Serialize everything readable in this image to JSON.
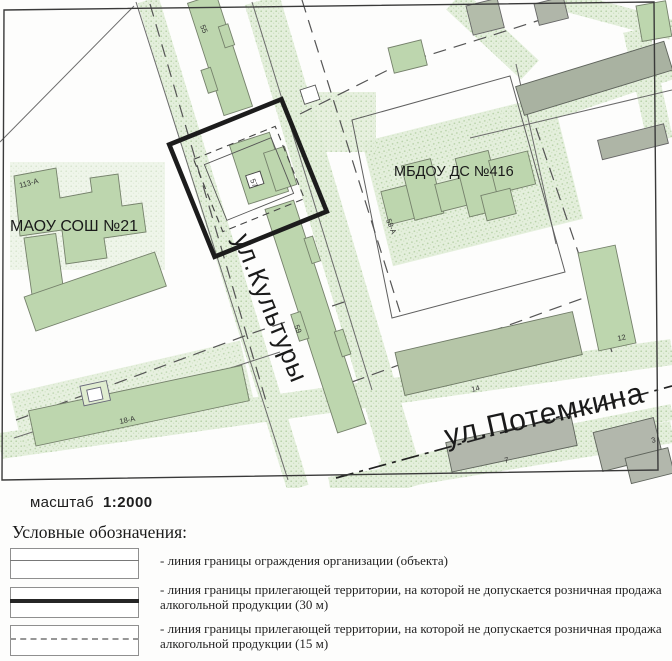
{
  "map": {
    "scale_label": "масштаб",
    "scale_value": "1:2000",
    "streets": {
      "kultury": "ул.Культуры",
      "potemkina": "ул.Потемкина"
    },
    "facilities": {
      "school": "МАОУ СОШ №21",
      "kindergarten": "МБДОУ ДС №416"
    },
    "numbers": {
      "b113": "113-А",
      "b55": "55",
      "b57": "57",
      "b59": "59",
      "b59a": "59-А",
      "b18a": "18-А",
      "b14": "14",
      "b12": "12",
      "b7": "7",
      "b3": "3"
    },
    "colors": {
      "building_green": "#bdd6ae",
      "building_gray": "#aeb5a6",
      "vegetation": "#e2eeda",
      "boundary_30m": "#1c1c1c"
    }
  },
  "legend": {
    "title": "Условные обозначения:",
    "items": [
      {
        "type": "thin-solid",
        "label": "- линия границы ограждения организации (объекта)"
      },
      {
        "type": "thick-solid",
        "label": "- линия границы прилегающей территории, на которой не допускается розничная продажа алкогольной продукции (30 м)"
      },
      {
        "type": "dashed",
        "label": "- линия границы прилегающей территории, на которой не допускается розничная продажа алкогольной продукции (15 м)"
      }
    ]
  }
}
